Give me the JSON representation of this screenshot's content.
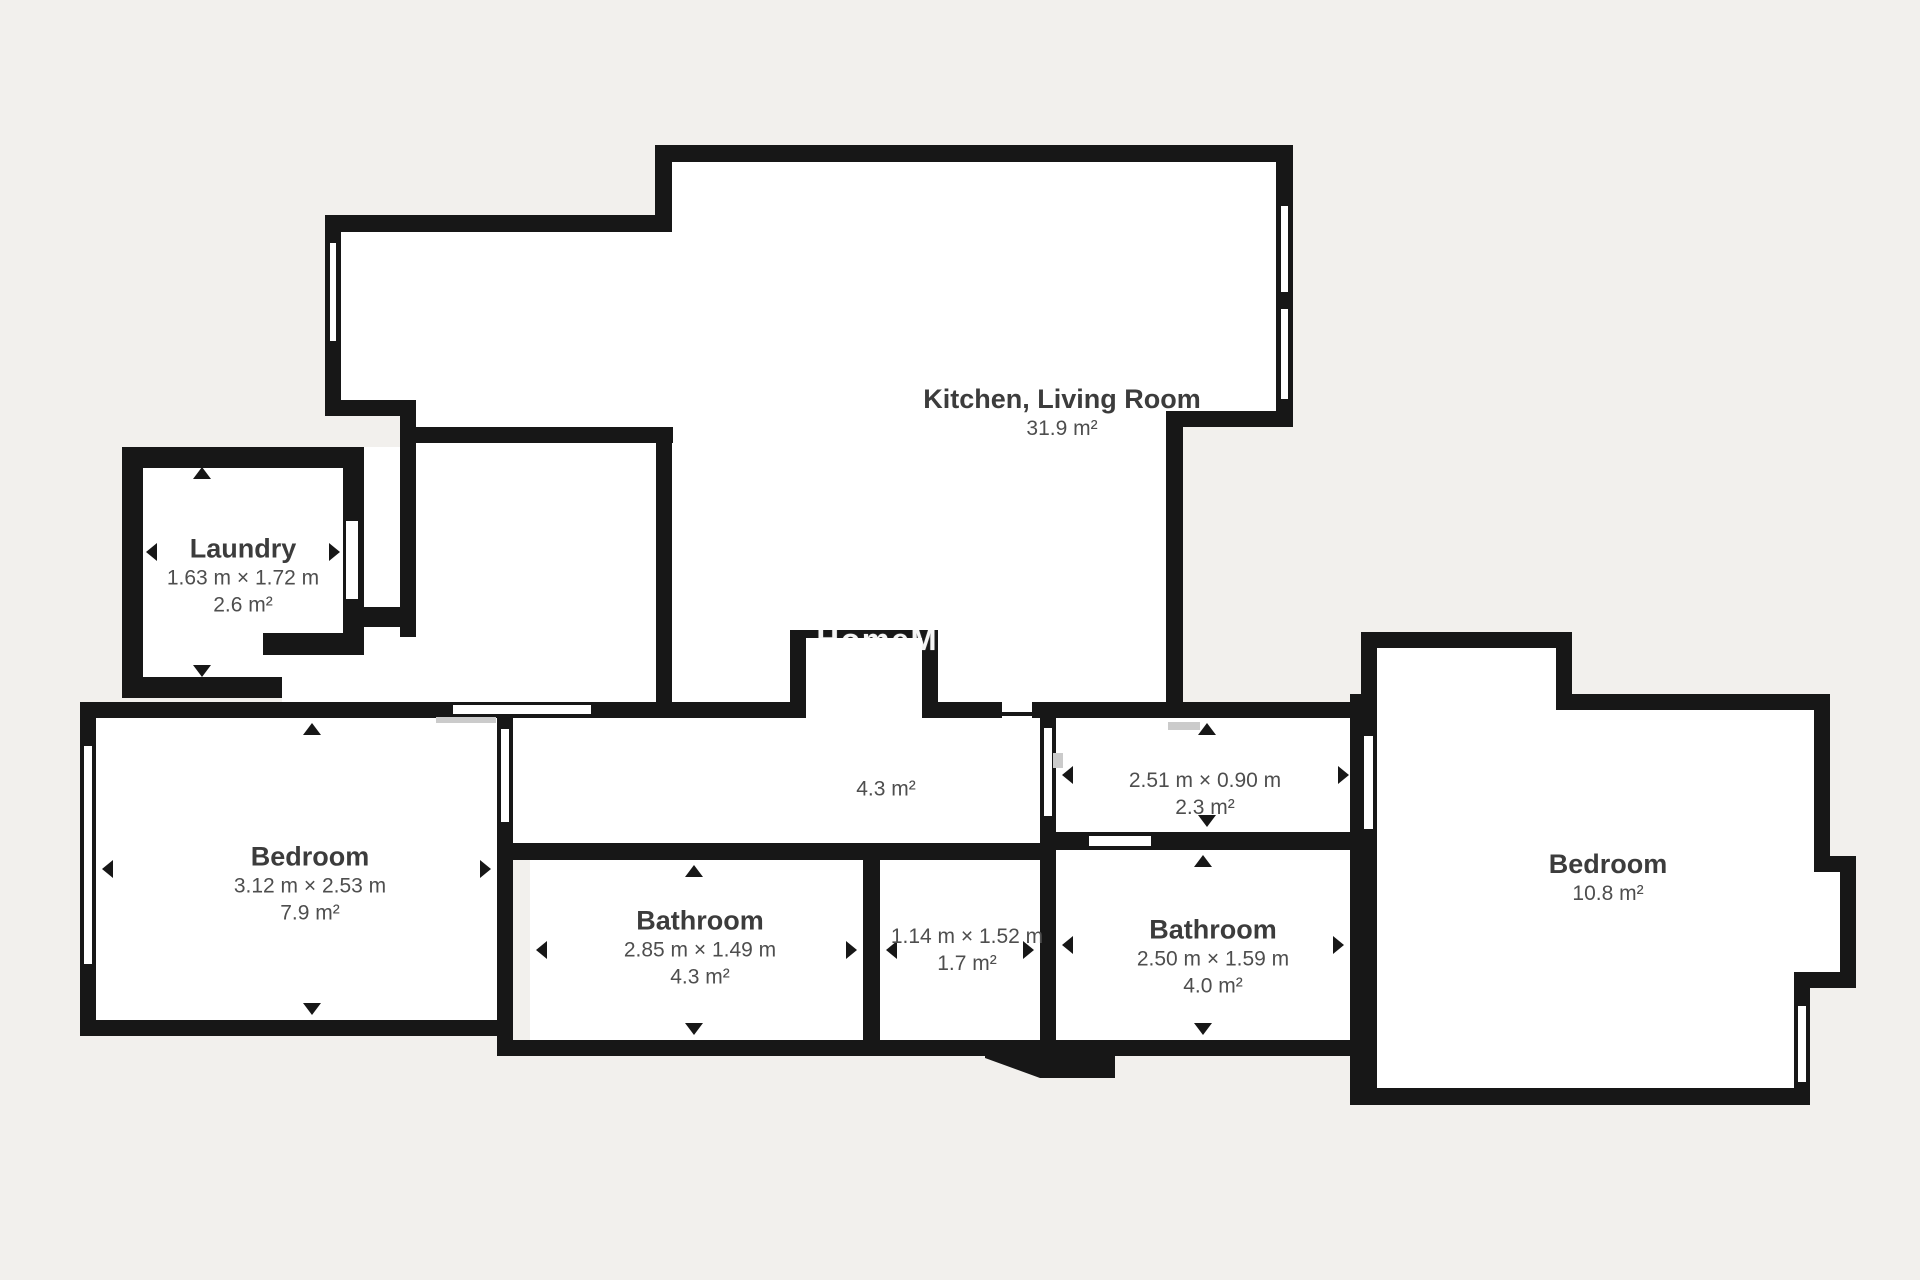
{
  "page": {
    "background": "#f2f0ed",
    "wall_color": "#171717",
    "room_fill": "#ffffff",
    "label_color": "#3c3c3c",
    "dim_color": "#4e4e4e",
    "watermark": "HomeMo"
  },
  "rooms": {
    "kitchen_living": {
      "name": "Kitchen, Living Room",
      "area": "31.9 m²"
    },
    "laundry": {
      "name": "Laundry",
      "dims": "1.63 m × 1.72 m",
      "area": "2.6 m²"
    },
    "bedroom_left": {
      "name": "Bedroom",
      "dims": "3.12 m × 2.53 m",
      "area": "7.9 m²"
    },
    "bathroom_left": {
      "name": "Bathroom",
      "dims": "2.85 m × 1.49 m",
      "area": "4.3 m²"
    },
    "wc": {
      "dims": "1.14 m × 1.52 m",
      "area": "1.7 m²"
    },
    "hall": {
      "area": "4.3 m²"
    },
    "corridor": {
      "dims": "2.51 m × 0.90 m",
      "area": "2.3 m²"
    },
    "bathroom_right": {
      "name": "Bathroom",
      "dims": "2.50 m × 1.59 m",
      "area": "4.0 m²"
    },
    "bedroom_right": {
      "name": "Bedroom",
      "area": "10.8 m²"
    }
  }
}
